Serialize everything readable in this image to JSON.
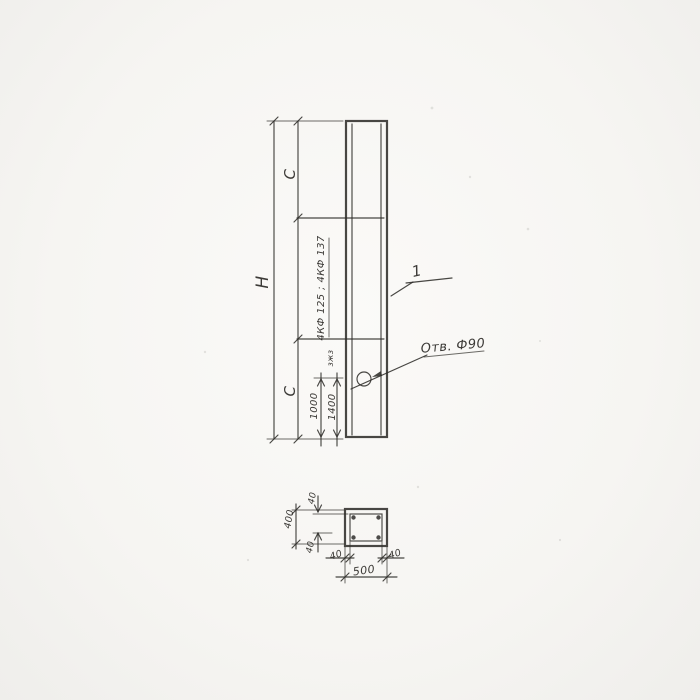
{
  "page": {
    "background_color": "#f6f5f2",
    "ink_color": "#2f2d2a",
    "description": "Scanned hand-drawn engineering drawing of a precast fachwerk column with a front elevation view and a cross-section view"
  },
  "front_view": {
    "label_overall_height": "Н",
    "label_c_top": "С",
    "label_c_bottom": "С",
    "label_series_marks": "4КФ 125 ; 4КФ 137",
    "label_small_note": "зжз",
    "label_hole_offset_1": "1000",
    "label_hole_offset_2": "1400",
    "label_hole_callout": "Отв. Ф90",
    "label_item_number": "1"
  },
  "section_view": {
    "label_wall_top": "40",
    "label_overall_depth": "400",
    "label_wall_bottom": "40",
    "label_wall_left": "40",
    "label_wall_right": "40",
    "label_overall_width": "500"
  }
}
